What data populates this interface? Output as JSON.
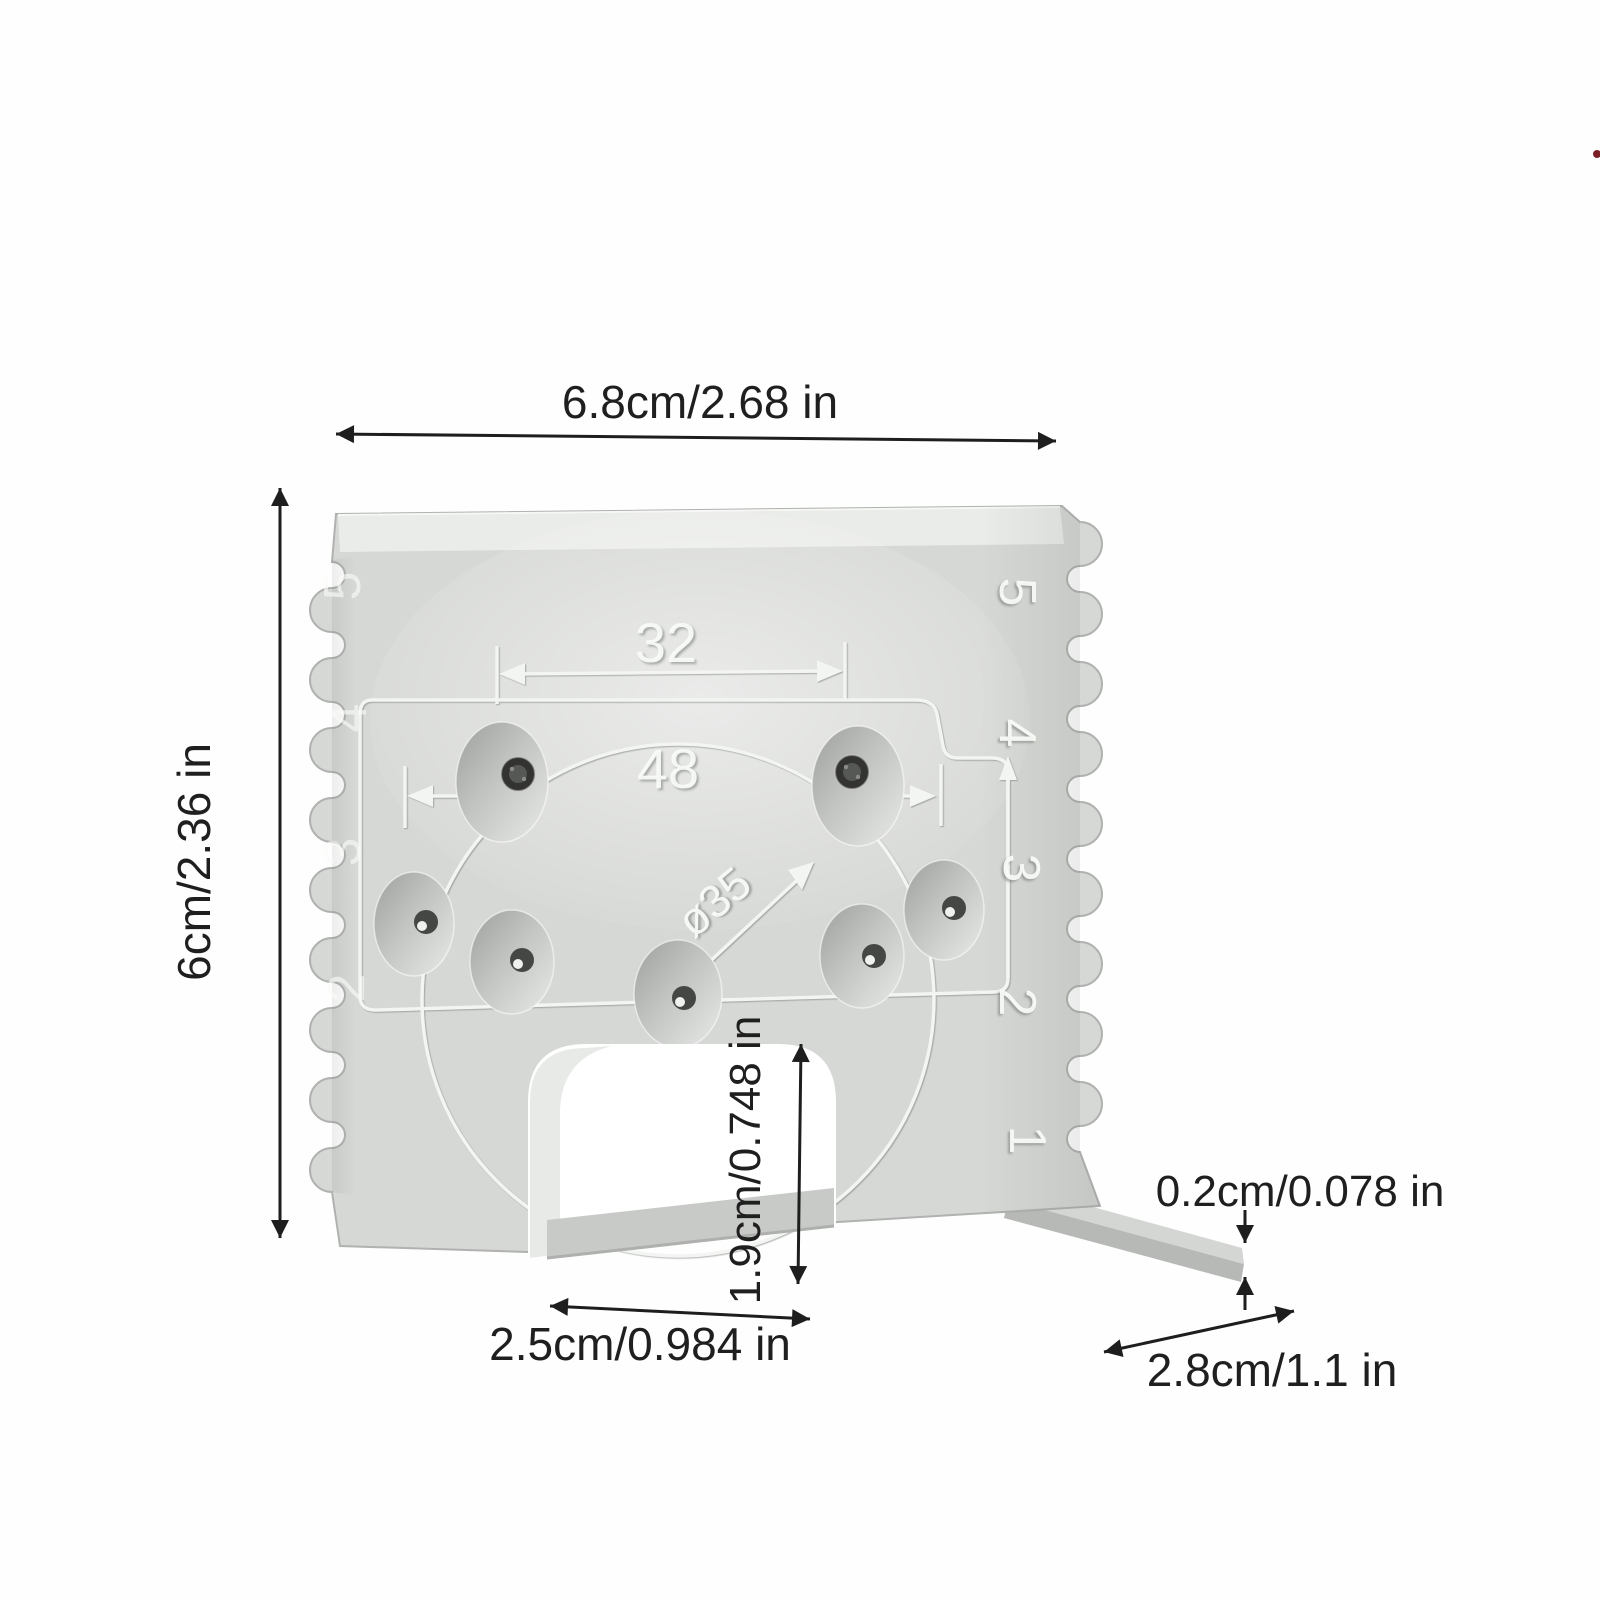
{
  "dimension_labels": {
    "top_width": "6.8cm/2.68 in",
    "left_height": "6cm/2.36 in",
    "opening_height": "1.9cm/0.748 in",
    "plate_thickness": "0.2cm/0.078 in",
    "opening_width": "2.5cm/0.984 in",
    "base_depth": "2.8cm/1.1 in"
  },
  "engraved_markings": {
    "top_hole_spacing": "32",
    "mid_hole_spacing": "48",
    "circle_diameter": "ø35",
    "right_scale": [
      "5",
      "4",
      "3",
      "2",
      "1"
    ],
    "left_scale": [
      "5",
      "4",
      "3",
      "2"
    ]
  },
  "colors": {
    "plate": "#d6d8d5",
    "plate_top": "#eaece9",
    "engraving": "#f3f5f2",
    "base_plate": "#c8cac7",
    "dimension_ink": "#1f1f1f"
  }
}
